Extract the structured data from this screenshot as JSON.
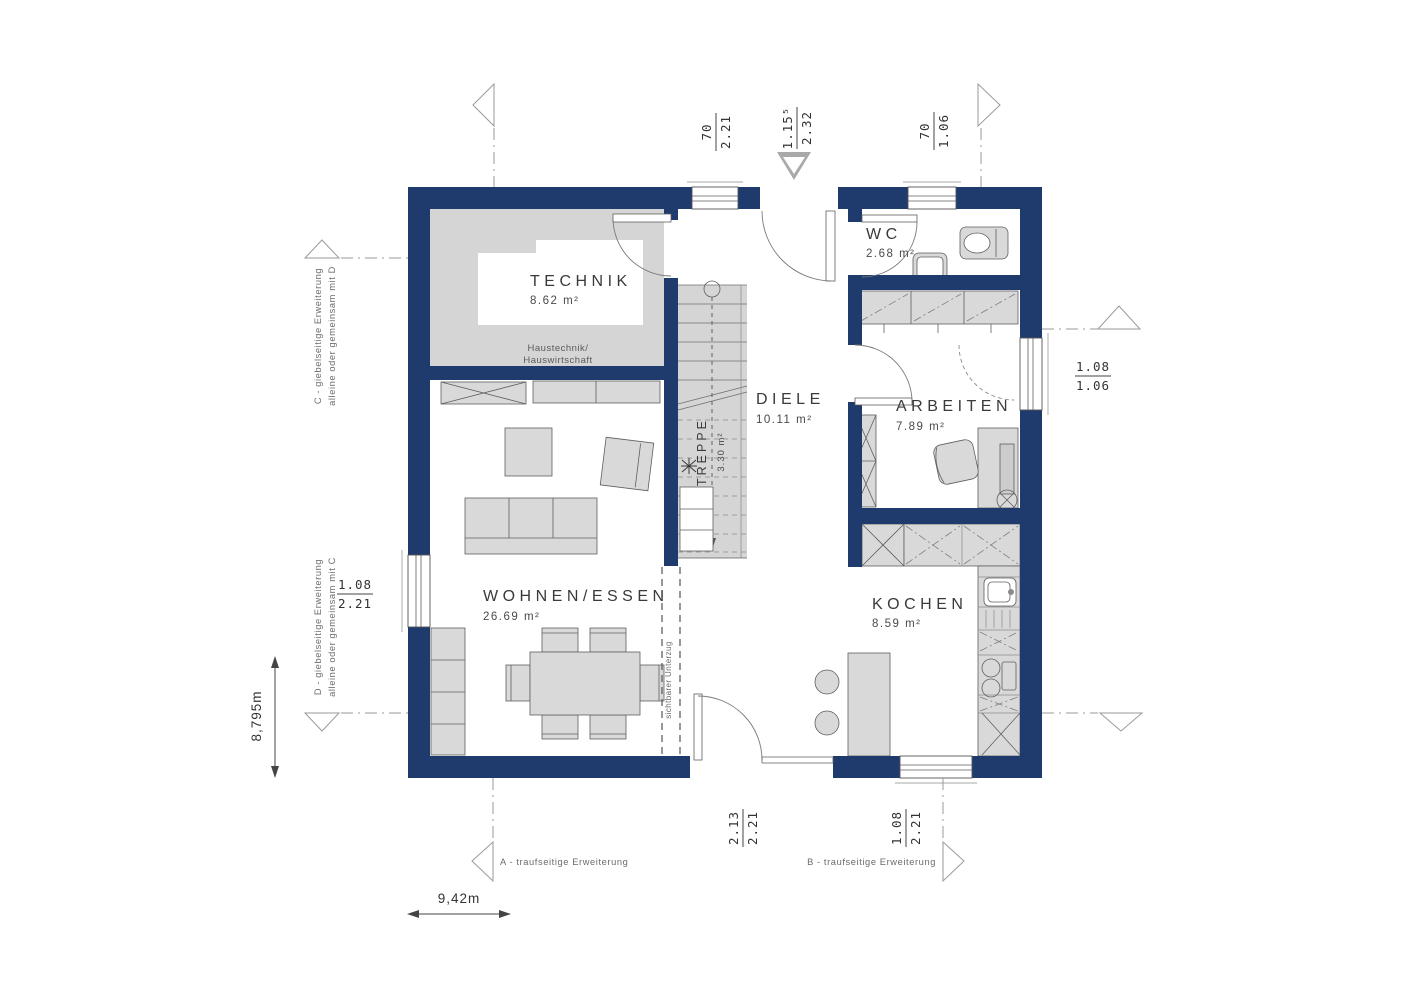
{
  "colors": {
    "wall_navy": "#1f3a6d",
    "floor_gray": "#d5d5d5"
  },
  "rooms": {
    "technik": {
      "name": "TECHNIK",
      "area": "8.62 m²",
      "note_line1": "Haustechnik/",
      "note_line2": "Hauswirtschaft"
    },
    "wc": {
      "name": "WC",
      "area": "2.68 m²"
    },
    "diele": {
      "name": "DIELE",
      "area": "10.11 m²"
    },
    "treppe": {
      "name": "TREPPE",
      "area": "3.30 m²"
    },
    "arbeiten": {
      "name": "ARBEITEN",
      "area": "7.89 m²"
    },
    "kochen": {
      "name": "KOCHEN",
      "area": "8.59 m²"
    },
    "wohnen": {
      "name": "WOHNEN/ESSEN",
      "area": "26.69 m²"
    }
  },
  "dimensions": {
    "window_top": {
      "num": "70",
      "den": "2.21"
    },
    "entry_door": {
      "num": "1.15⁵",
      "den": "2.32"
    },
    "window_wc": {
      "num": "70",
      "den": "1.06"
    },
    "window_arbeiten": {
      "num": "1.08",
      "den": "1.06"
    },
    "window_wohnen": {
      "num": "1.08",
      "den": "2.21"
    },
    "door_terrace": {
      "num": "2.13",
      "den": "2.21"
    },
    "window_kochen": {
      "num": "1.08",
      "den": "2.21"
    },
    "overall_width": "9,42m",
    "overall_depth": "8,795m"
  },
  "annotations": {
    "axis_a": "A - traufseitige Erweiterung",
    "axis_b": "B - traufseitige Erweiterung",
    "axis_c_line1": "C - giebelseitige Erweiterung",
    "axis_c_line2": "alleine oder gemeinsam mit D",
    "axis_d_line1": "D - giebelseitige Erweiterung",
    "axis_d_line2": "alleine oder gemeinsam mit C",
    "beam_note": "sichtbarer Unterzug"
  }
}
